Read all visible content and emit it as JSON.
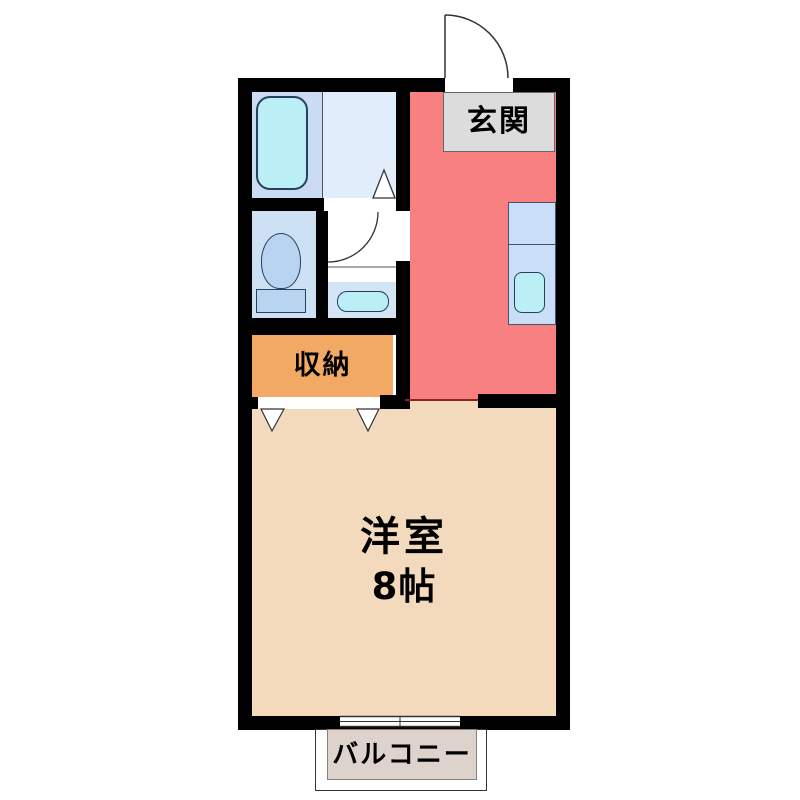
{
  "floorplan": {
    "type": "japanese-apartment-1K",
    "rooms": {
      "genkan": {
        "label": "玄関",
        "floor_color": "#f98080",
        "label_bg": "#dcdcdc"
      },
      "storage": {
        "label": "収納",
        "floor_color": "#f1a963"
      },
      "western_room": {
        "label": "洋室",
        "size": "8帖",
        "floor_color": "#f3dabd"
      },
      "balcony": {
        "label": "バルコニー",
        "floor_color": "#ded3cc"
      },
      "bathroom": {
        "floor_color": "#cbdcf2"
      },
      "washroom": {
        "floor_color": "#e1edfa"
      },
      "toilet_room": {
        "floor_color": "#cde0f4"
      },
      "vanity_room": {
        "floor_color": "#d3e4f6"
      }
    },
    "fixtures": [
      "bathtub",
      "toilet",
      "vanity-sink",
      "kitchen-counter",
      "kitchen-sink",
      "entrance-door-swing",
      "interior-door-swing",
      "storage-folding-door",
      "sliding-window"
    ],
    "colors": {
      "wall": "#000000",
      "fixture_cyan": "#bceef6",
      "fixture_blue": "#b9d4f0",
      "fixture_outline": "#24415f",
      "kitchen_counter": "#cadff7",
      "hall_room_divider": "#8b2424",
      "door_line": "#333333"
    }
  }
}
